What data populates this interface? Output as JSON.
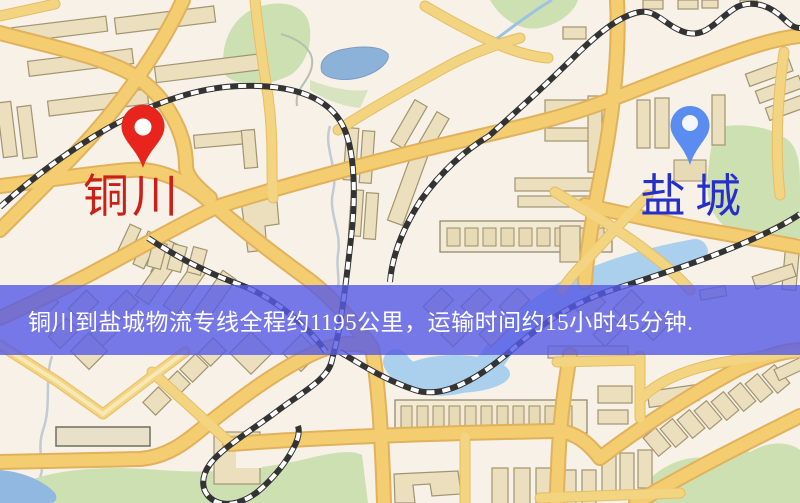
{
  "banner": {
    "text": "铜川到盐城物流专线全程约1195公里，运输时间约15小时45分钟."
  },
  "route": {
    "origin": "铜川",
    "destination": "盐城",
    "distance_km": "1195",
    "duration": "15小时45分钟"
  },
  "markers": [
    {
      "id": "origin",
      "label": "铜川",
      "pin_color": "#e8251c",
      "label_color": "#cc1f17"
    },
    {
      "id": "destination",
      "label": "盐城",
      "pin_color": "#5b8df0",
      "label_color": "#2630c8"
    }
  ],
  "palette": {
    "map_background": "#f7f1e8",
    "road_yellow": "#f5cd6e",
    "park_green": "#cde0b0",
    "water_blue": "#8cb2da",
    "railway_dark": "#333333",
    "banner_background": "#565ae6",
    "banner_text": "#ffffff"
  }
}
